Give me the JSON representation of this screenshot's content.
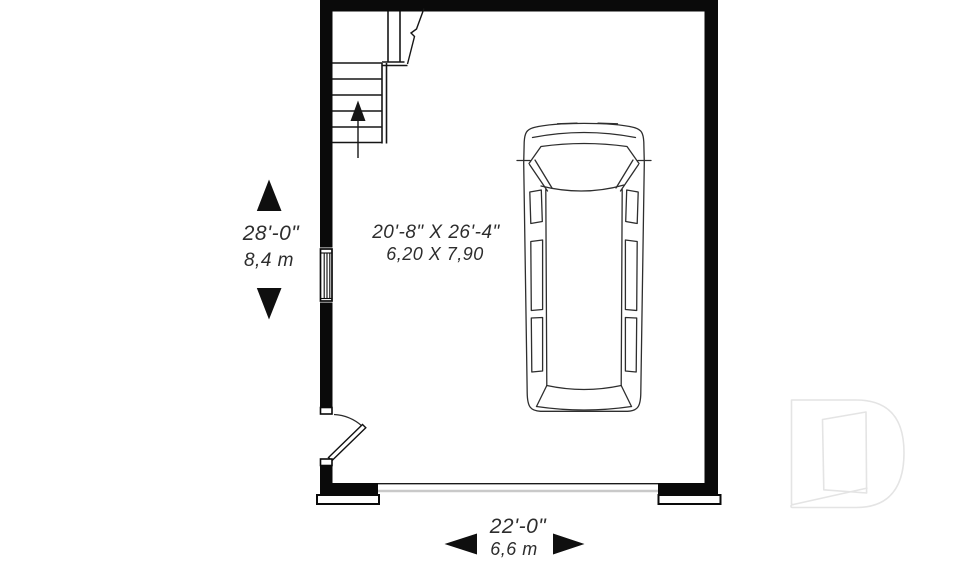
{
  "plan": {
    "type": "garage-floor-plan",
    "interior_dimensions": {
      "imperial": "20'-8\" X 26'-4\"",
      "metric": "6,20 X 7,90"
    },
    "vertical_dimension": {
      "imperial": "28'-0\"",
      "metric": "8,4 m"
    },
    "horizontal_dimension": {
      "imperial": "22'-0\"",
      "metric": "6,6 m"
    }
  },
  "colors": {
    "wall": "#0a0a0a",
    "line": "#1a1a1a",
    "car_line": "#2e2e2e",
    "garage_door_line": "#c9c9c9",
    "logo_outline": "#e4e4e4",
    "text": "#2d2d2d",
    "background": "#ffffff"
  },
  "icons": [
    "dimension-arrow-up-icon",
    "dimension-arrow-down-icon",
    "dimension-arrow-left-icon",
    "dimension-arrow-right-icon",
    "stair-direction-arrow-icon",
    "car-top-view",
    "d-logo-watermark"
  ]
}
